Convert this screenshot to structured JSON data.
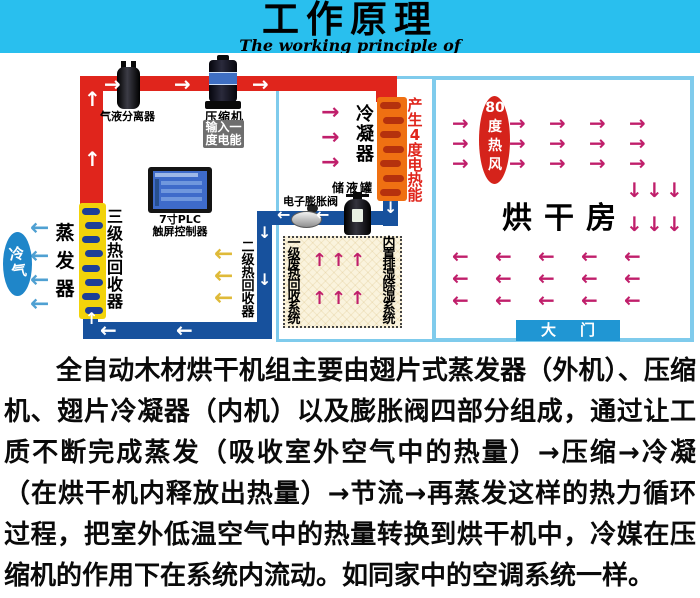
{
  "banner": {
    "title": "工作原理",
    "subtitle": "The working principle of",
    "bg_color": "#29bfee"
  },
  "diagram": {
    "machine_labels": {
      "cold_air": "冷气",
      "evaporator": "蒸发器",
      "heat_recovery_3": "三级热回收器",
      "heat_recovery_2": "二级热回收器",
      "gas_liquid_separator": "气液分离器",
      "compressor": "压缩机",
      "power_input_line1": "输入一",
      "power_input_line2": "度电能",
      "plc_line1": "7寸PLC",
      "plc_line2": "触屏控制器",
      "expansion_valve": "电子膨胀阀",
      "receiver_tank": "储液罐",
      "condenser": "冷凝器",
      "heat_output": "产生4度电热能",
      "waste_heat_recovery_1": "一级废热回收系统",
      "dehumidify_system": "内置排湿除湿系统"
    },
    "drying_room": {
      "name": "烘干房",
      "hot_air": "80度热风",
      "gate": "大门"
    },
    "colors": {
      "hot_pipe": "#e0251c",
      "cold_pipe": "#17519d",
      "condenser_coil": "#ef7012",
      "recovery_coil": "#f2d30a",
      "room_border": "#7fcbec",
      "flow_arrow_magenta": "#c01f6b",
      "cold_arrow": "#4fa0d2",
      "recovery_arrow": "#dfba39",
      "hot_air_badge": "#d5231b",
      "gate_bg": "#2096d3",
      "heat_output_text": "#e0251c"
    }
  },
  "description": "全自动木材烘干机组主要由翅片式蒸发器（外机）、压缩机、翅片冷凝器（内机）以及膨胀阀四部分组成，通过让工质不断完成蒸发（吸收室外空气中的热量）→压缩→冷凝（在烘干机内释放出热量）→节流→再蒸发这样的热力循环过程，把室外低温空气中的热量转换到烘干机中，冷媒在压缩机的作用下在系统内流动。如同家中的空调系统一样。"
}
